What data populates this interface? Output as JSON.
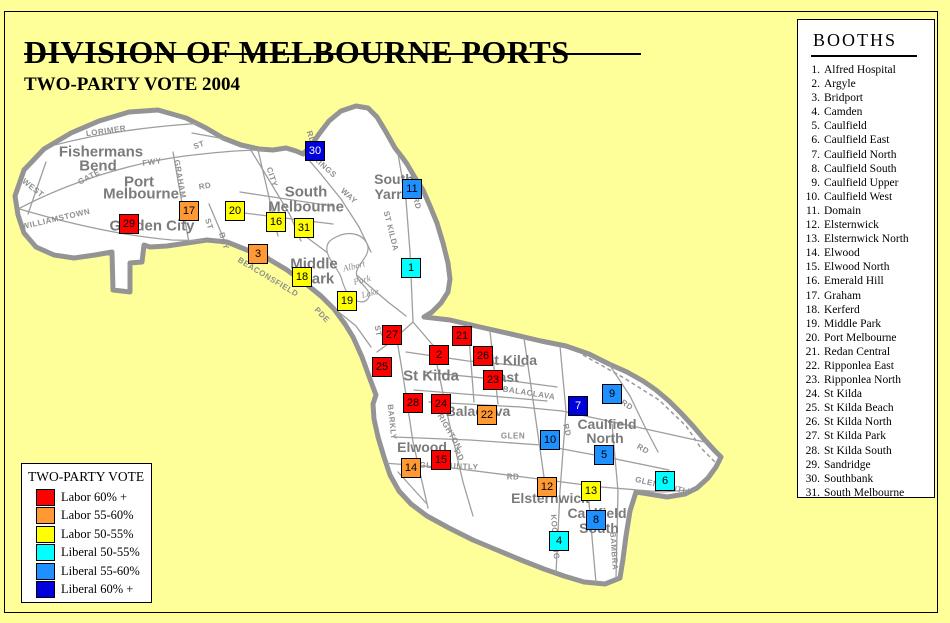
{
  "title": "DIVISION OF MELBOURNE PORTS",
  "subtitle": "TWO-PARTY VOTE 2004",
  "booths_panel": {
    "title": "BOOTHS",
    "items": [
      {
        "num": "1.",
        "name": "Alfred Hospital"
      },
      {
        "num": "2.",
        "name": "Argyle"
      },
      {
        "num": "3.",
        "name": "Bridport"
      },
      {
        "num": "4.",
        "name": "Camden"
      },
      {
        "num": "5.",
        "name": "Caulfield"
      },
      {
        "num": "6.",
        "name": "Caulfield East"
      },
      {
        "num": "7.",
        "name": "Caulfield North"
      },
      {
        "num": "8.",
        "name": "Caulfield South"
      },
      {
        "num": "9.",
        "name": "Caulfield Upper"
      },
      {
        "num": "10.",
        "name": "Caulfield West"
      },
      {
        "num": "11.",
        "name": "Domain"
      },
      {
        "num": "12.",
        "name": "Elsternwick"
      },
      {
        "num": "13.",
        "name": "Elsternwick North"
      },
      {
        "num": "14.",
        "name": "Elwood"
      },
      {
        "num": "15.",
        "name": "Elwood North"
      },
      {
        "num": "16.",
        "name": "Emerald Hill"
      },
      {
        "num": "17.",
        "name": "Graham"
      },
      {
        "num": "18.",
        "name": "Kerferd"
      },
      {
        "num": "19.",
        "name": "Middle Park"
      },
      {
        "num": "20.",
        "name": "Port Melbourne"
      },
      {
        "num": "21.",
        "name": "Redan Central"
      },
      {
        "num": "22.",
        "name": "Ripponlea East"
      },
      {
        "num": "23.",
        "name": "Ripponlea North"
      },
      {
        "num": "24.",
        "name": "St Kilda"
      },
      {
        "num": "25.",
        "name": "St Kilda Beach"
      },
      {
        "num": "26.",
        "name": "St Kilda North"
      },
      {
        "num": "27.",
        "name": "St Kilda Park"
      },
      {
        "num": "28.",
        "name": "St Kilda South"
      },
      {
        "num": "29.",
        "name": "Sandridge"
      },
      {
        "num": "30.",
        "name": "Southbank"
      },
      {
        "num": "31.",
        "name": "South Melbourne"
      }
    ]
  },
  "legend": {
    "title": "TWO-PARTY VOTE",
    "items": [
      {
        "label": "Labor 60% +",
        "category": "labor60",
        "color": "#FF0000"
      },
      {
        "label": "Labor 55-60%",
        "category": "labor55",
        "color": "#FF9933"
      },
      {
        "label": "Labor 50-55%",
        "category": "labor50",
        "color": "#FFFF00"
      },
      {
        "label": "Liberal 50-55%",
        "category": "liberal50",
        "color": "#00FFFF"
      },
      {
        "label": "Liberal 55-60%",
        "category": "liberal55",
        "color": "#1E90FF"
      },
      {
        "label": "Liberal 60% +",
        "category": "liberal60",
        "color": "#0000DD"
      }
    ]
  },
  "colors": {
    "background": "#FFFF99",
    "map_fill": "#FFFFFF",
    "map_border": "#949494",
    "labor60": "#FF0000",
    "labor55": "#FF9933",
    "labor50": "#FFFF00",
    "liberal50": "#00FFFF",
    "liberal55": "#1E90FF",
    "liberal60": "#0000DD",
    "liberal60_text": "#FFFFFF"
  },
  "map": {
    "markers": [
      {
        "num": "1",
        "x": 411,
        "y": 268,
        "category": "liberal50"
      },
      {
        "num": "2",
        "x": 439,
        "y": 355,
        "category": "labor60"
      },
      {
        "num": "3",
        "x": 258,
        "y": 254,
        "category": "labor55"
      },
      {
        "num": "4",
        "x": 559,
        "y": 541,
        "category": "liberal50"
      },
      {
        "num": "5",
        "x": 604,
        "y": 455,
        "category": "liberal55"
      },
      {
        "num": "6",
        "x": 665,
        "y": 481,
        "category": "liberal50"
      },
      {
        "num": "7",
        "x": 578,
        "y": 406,
        "category": "liberal60"
      },
      {
        "num": "8",
        "x": 596,
        "y": 520,
        "category": "liberal55"
      },
      {
        "num": "9",
        "x": 612,
        "y": 394,
        "category": "liberal55"
      },
      {
        "num": "10",
        "x": 550,
        "y": 440,
        "category": "liberal55"
      },
      {
        "num": "11",
        "x": 412,
        "y": 189,
        "category": "liberal55"
      },
      {
        "num": "12",
        "x": 547,
        "y": 487,
        "category": "labor55"
      },
      {
        "num": "13",
        "x": 591,
        "y": 491,
        "category": "labor50"
      },
      {
        "num": "14",
        "x": 411,
        "y": 468,
        "category": "labor55"
      },
      {
        "num": "15",
        "x": 441,
        "y": 460,
        "category": "labor60"
      },
      {
        "num": "16",
        "x": 276,
        "y": 222,
        "category": "labor50"
      },
      {
        "num": "17",
        "x": 189,
        "y": 211,
        "category": "labor55"
      },
      {
        "num": "18",
        "x": 302,
        "y": 277,
        "category": "labor50"
      },
      {
        "num": "19",
        "x": 347,
        "y": 301,
        "category": "labor50"
      },
      {
        "num": "20",
        "x": 235,
        "y": 211,
        "category": "labor50"
      },
      {
        "num": "21",
        "x": 462,
        "y": 336,
        "category": "labor60"
      },
      {
        "num": "22",
        "x": 487,
        "y": 415,
        "category": "labor55"
      },
      {
        "num": "23",
        "x": 493,
        "y": 380,
        "category": "labor60"
      },
      {
        "num": "24",
        "x": 441,
        "y": 404,
        "category": "labor60"
      },
      {
        "num": "25",
        "x": 382,
        "y": 367,
        "category": "labor60"
      },
      {
        "num": "26",
        "x": 483,
        "y": 356,
        "category": "labor60"
      },
      {
        "num": "27",
        "x": 392,
        "y": 335,
        "category": "labor60"
      },
      {
        "num": "28",
        "x": 413,
        "y": 403,
        "category": "labor60"
      },
      {
        "num": "29",
        "x": 129,
        "y": 224,
        "category": "labor60"
      },
      {
        "num": "30",
        "x": 315,
        "y": 151,
        "category": "liberal60"
      },
      {
        "num": "31",
        "x": 304,
        "y": 228,
        "category": "labor50"
      }
    ],
    "suburb_labels": [
      {
        "text": "Fishermans",
        "x": 101,
        "y": 152,
        "size": 15
      },
      {
        "text": "Bend",
        "x": 98,
        "y": 166,
        "size": 15
      },
      {
        "text": "Port",
        "x": 139,
        "y": 182,
        "size": 15
      },
      {
        "text": "Melbourne",
        "x": 141,
        "y": 194,
        "size": 15
      },
      {
        "text": "Garden City",
        "x": 152,
        "y": 226,
        "size": 15
      },
      {
        "text": "South",
        "x": 306,
        "y": 192,
        "size": 15
      },
      {
        "text": "Melbourne",
        "x": 306,
        "y": 207,
        "size": 15
      },
      {
        "text": "South",
        "x": 394,
        "y": 179,
        "size": 14
      },
      {
        "text": "Yarra",
        "x": 392,
        "y": 194,
        "size": 14
      },
      {
        "text": "Middle",
        "x": 314,
        "y": 264,
        "size": 15
      },
      {
        "text": "Park",
        "x": 318,
        "y": 279,
        "size": 15
      },
      {
        "text": "St Kilda",
        "x": 431,
        "y": 376,
        "size": 15
      },
      {
        "text": "St Kilda",
        "x": 511,
        "y": 360,
        "size": 14
      },
      {
        "text": "East",
        "x": 504,
        "y": 377,
        "size": 14
      },
      {
        "text": "Balaclava",
        "x": 478,
        "y": 411,
        "size": 14
      },
      {
        "text": "Elwood",
        "x": 422,
        "y": 447,
        "size": 14
      },
      {
        "text": "Elsternwick",
        "x": 550,
        "y": 498,
        "size": 14
      },
      {
        "text": "Caulfield",
        "x": 607,
        "y": 424,
        "size": 14
      },
      {
        "text": "North",
        "x": 605,
        "y": 438,
        "size": 14
      },
      {
        "text": "Caulfield",
        "x": 597,
        "y": 513,
        "size": 14
      },
      {
        "text": "South",
        "x": 599,
        "y": 528,
        "size": 14
      }
    ],
    "road_labels": [
      {
        "text": "LORIMER",
        "x": 106,
        "y": 131,
        "rot": -8
      },
      {
        "text": "ST",
        "x": 199,
        "y": 145,
        "rot": -20
      },
      {
        "text": "FWY",
        "x": 152,
        "y": 162,
        "rot": -8
      },
      {
        "text": "WEST",
        "x": 33,
        "y": 188,
        "rot": 38
      },
      {
        "text": "GATE",
        "x": 89,
        "y": 177,
        "rot": -28
      },
      {
        "text": "WILLIAMSTOWN",
        "x": 56,
        "y": 219,
        "rot": -13
      },
      {
        "text": "GRAHAM",
        "x": 180,
        "y": 179,
        "rot": 80
      },
      {
        "text": "RD",
        "x": 205,
        "y": 186,
        "rot": -10
      },
      {
        "text": "RD",
        "x": 311,
        "y": 137,
        "rot": 72
      },
      {
        "text": "CITY",
        "x": 272,
        "y": 177,
        "rot": 72
      },
      {
        "text": "KINGS",
        "x": 325,
        "y": 167,
        "rot": 42
      },
      {
        "text": "WAY",
        "x": 349,
        "y": 196,
        "rot": 42
      },
      {
        "text": "ST KILDA",
        "x": 391,
        "y": 231,
        "rot": 76
      },
      {
        "text": "RD",
        "x": 417,
        "y": 203,
        "rot": 76
      },
      {
        "text": "BAY",
        "x": 224,
        "y": 241,
        "rot": 72
      },
      {
        "text": "ST",
        "x": 209,
        "y": 224,
        "rot": 72
      },
      {
        "text": "BEACONSFIELD",
        "x": 268,
        "y": 277,
        "rot": 31
      },
      {
        "text": "PDE",
        "x": 322,
        "y": 315,
        "rot": 46
      },
      {
        "text": "ST",
        "x": 378,
        "y": 331,
        "rot": 80
      },
      {
        "text": "BARKLY",
        "x": 392,
        "y": 422,
        "rot": 84
      },
      {
        "text": "BRIGHTON",
        "x": 448,
        "y": 429,
        "rot": 60
      },
      {
        "text": "RD",
        "x": 459,
        "y": 455,
        "rot": 60
      },
      {
        "text": "BALACLAVA",
        "x": 529,
        "y": 393,
        "rot": 9
      },
      {
        "text": "GLEN",
        "x": 513,
        "y": 436,
        "rot": 0
      },
      {
        "text": "RD",
        "x": 567,
        "y": 430,
        "rot": 76
      },
      {
        "text": "RD",
        "x": 627,
        "y": 405,
        "rot": 33
      },
      {
        "text": "RD",
        "x": 643,
        "y": 449,
        "rot": 30
      },
      {
        "text": "GLENHUNTLY",
        "x": 449,
        "y": 466,
        "rot": 2
      },
      {
        "text": "RD",
        "x": 513,
        "y": 477,
        "rot": 0
      },
      {
        "text": "GLENHUNTLY",
        "x": 664,
        "y": 486,
        "rot": 13
      },
      {
        "text": "KOOYONG",
        "x": 555,
        "y": 537,
        "rot": 86
      },
      {
        "text": "BAMBRA",
        "x": 614,
        "y": 551,
        "rot": 86
      }
    ],
    "lake_labels": [
      {
        "text": "Albert",
        "x": 354,
        "y": 266,
        "rot": -14
      },
      {
        "text": "Park",
        "x": 362,
        "y": 280,
        "rot": -14
      },
      {
        "text": "Lake",
        "x": 370,
        "y": 293,
        "rot": -14
      }
    ]
  }
}
